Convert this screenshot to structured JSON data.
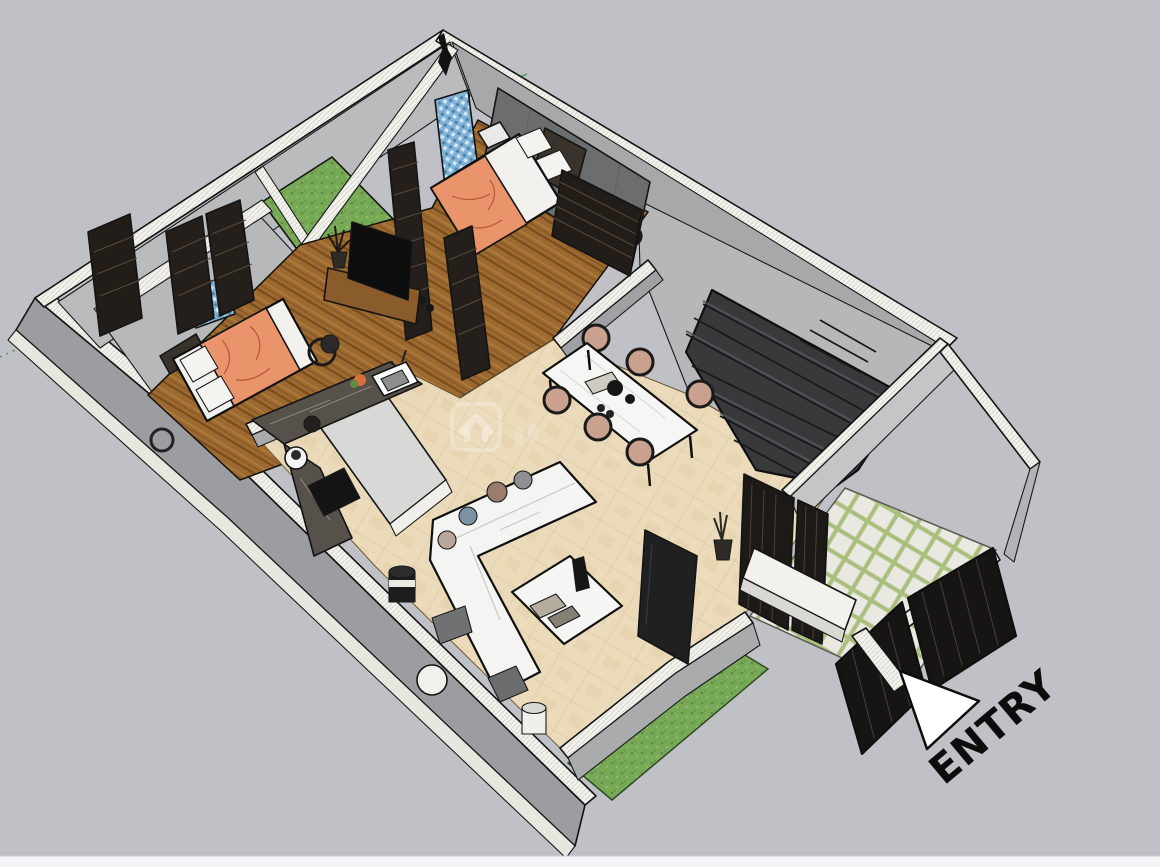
{
  "scene": {
    "title": "3D isometric floor plan render",
    "entry_label": "ENTRY",
    "watermark_icon": "house-chevron-watermark",
    "rooms": {
      "living_dining": "beige tile open area with sofa, coffee table and six-seat dining set",
      "kitchen": "L-shaped dark marble counter with sink and island",
      "bedroom_right": "wood floor bedroom with orange bed and dark accent wall",
      "bedroom_left": "wood floor bedroom with orange bed",
      "bathrooms": "blue mosaic floors",
      "stairwell": "dark dog-leg staircase",
      "entry_court": "paver path with dark gates and white bench",
      "lawn": "green lawn strip",
      "courtyard": "green grass patch at rear"
    },
    "colors": {
      "background": "#bfc1c6",
      "bottom_bar": "#f3f4f8",
      "wall_top": "#f3f2ec",
      "wall_face_light": "#c6c8ca",
      "wall_face_mid": "#b9bbbd",
      "wall_face_dark": "#9b9da0",
      "floor_tile": "#ecdcbb",
      "floor_wood": "#9c6a31",
      "floor_concrete": "#b5b7b8",
      "lawn": "#78a957",
      "courtyard_grass": "#6f9e4e",
      "bathroom_mosaic": "#7fb2d8",
      "stairs": "#37393b",
      "bed_blanket": "#e9946b",
      "chair_cushion": "#c9a18e",
      "counter_marble": "#57514b",
      "gate_panels": "#1c1917",
      "entry_text": "#0c0c0c"
    }
  }
}
